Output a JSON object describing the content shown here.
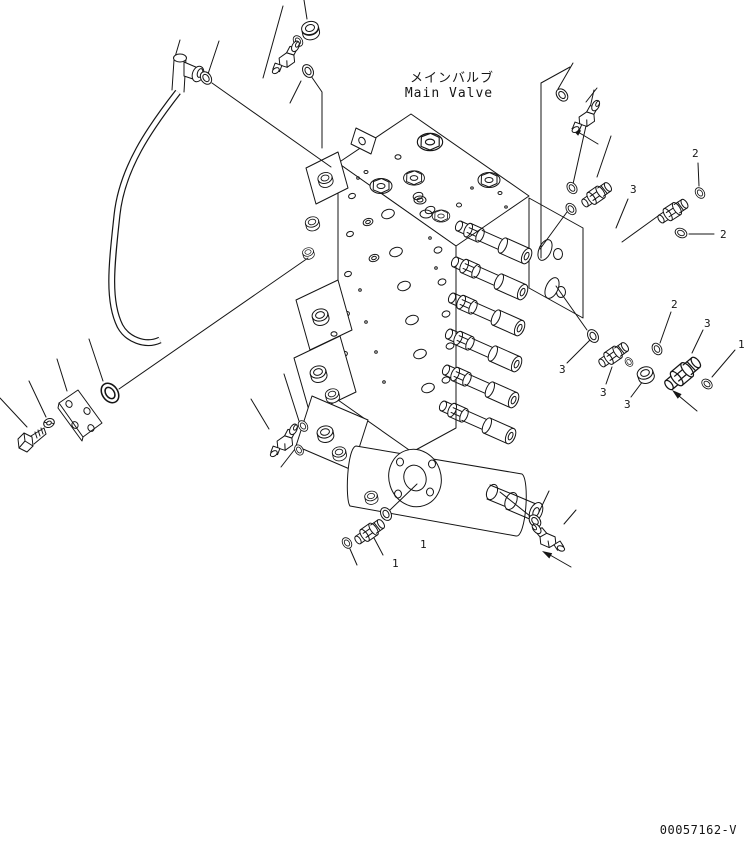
{
  "page": {
    "background": "#ffffff",
    "line_color": "#151515"
  },
  "diagram": {
    "title_ja": "メインバルブ",
    "title_en": "Main Valve",
    "drawing_number": "00057162-V",
    "callouts": [
      {
        "text": "2",
        "x": 692,
        "y": 157
      },
      {
        "text": "3",
        "x": 630,
        "y": 193
      },
      {
        "text": "2",
        "x": 720,
        "y": 238
      },
      {
        "text": "2",
        "x": 671,
        "y": 308
      },
      {
        "text": "3",
        "x": 704,
        "y": 327
      },
      {
        "text": "1",
        "x": 738,
        "y": 348
      },
      {
        "text": "3",
        "x": 559,
        "y": 373
      },
      {
        "text": "3",
        "x": 600,
        "y": 396
      },
      {
        "text": "3",
        "x": 624,
        "y": 408
      },
      {
        "text": "1",
        "x": 392,
        "y": 567
      },
      {
        "text": "1",
        "x": 420,
        "y": 548
      }
    ]
  }
}
